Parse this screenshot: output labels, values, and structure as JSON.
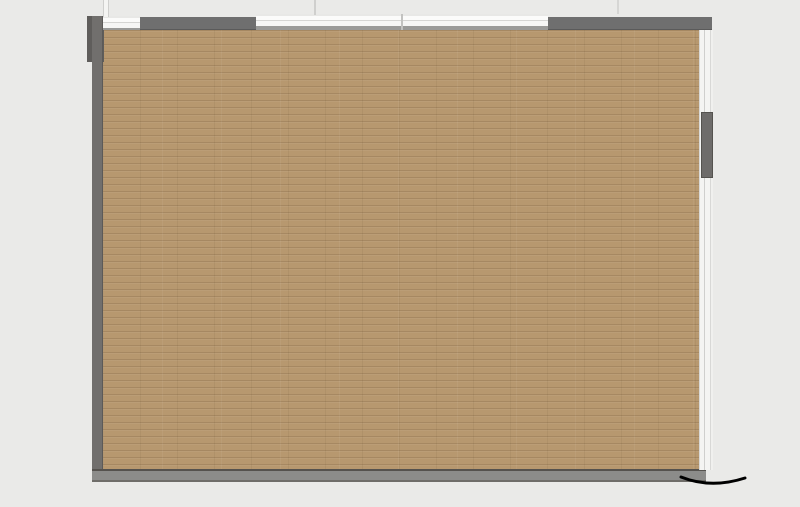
{
  "page": {
    "background": "#eaeae8"
  },
  "logo": {
    "text_en": "SEEWIN",
    "text_cn": "诗敏",
    "color": "#1b48b2"
  },
  "watermark": {
    "text": "SEEWIN 诗敏",
    "opacity": 0.4,
    "row_start": 241,
    "row_step": 44,
    "col_start": 14,
    "col_step": 93,
    "alt_row_offset": 46
  },
  "palette": {
    "floor": "#b7986f",
    "wall": "#716f6d",
    "wood": "#ddb278",
    "white_desk": "#f6f6f5",
    "chair_blue": "#7095c5",
    "chair_gray": "#dee0e1",
    "table_chair": "#7c9bb1",
    "arc_blue": "#27567f",
    "arc_wood": "#e2bc83",
    "hub": "#d9d9d7",
    "pouf_blue": "#4285c6",
    "pouf_orange": "#c88b1e",
    "bench_green": "#9aad55",
    "plant_green": "#2c5426",
    "dark_item": "#45301a",
    "black_item": "#2a2420"
  },
  "furniture": {
    "wood_rects": [
      {
        "name": "partition-panel",
        "x": 258,
        "y": 33,
        "w": 9,
        "h": 117
      },
      {
        "name": "partition-panel",
        "x": 468,
        "y": 32,
        "w": 10,
        "h": 131
      },
      {
        "name": "partition-panel",
        "x": 592,
        "y": 30,
        "w": 11,
        "h": 50
      },
      {
        "name": "shelf-column",
        "x": 100,
        "y": 226,
        "w": 15,
        "h": 172
      },
      {
        "name": "shelf-column",
        "x": 159,
        "y": 227,
        "w": 21,
        "h": 171
      },
      {
        "name": "shelf-column",
        "x": 215,
        "y": 227,
        "w": 22,
        "h": 171
      },
      {
        "name": "shelf-column",
        "x": 269,
        "y": 227,
        "w": 23,
        "h": 171
      },
      {
        "name": "desk-row",
        "x": 505,
        "y": 186,
        "w": 88,
        "h": 21
      },
      {
        "name": "desk-row",
        "x": 505,
        "y": 245,
        "w": 88,
        "h": 22
      },
      {
        "name": "desk-row",
        "x": 505,
        "y": 303,
        "w": 88,
        "h": 20
      },
      {
        "name": "desk-row",
        "x": 505,
        "y": 362,
        "w": 88,
        "h": 23
      },
      {
        "name": "desk-row",
        "x": 505,
        "y": 420,
        "w": 88,
        "h": 22
      },
      {
        "name": "desk-row",
        "x": 613,
        "y": 187,
        "w": 82,
        "h": 20
      },
      {
        "name": "desk-row",
        "x": 613,
        "y": 245,
        "w": 82,
        "h": 22
      },
      {
        "name": "desk-row",
        "x": 613,
        "y": 303,
        "w": 82,
        "h": 20
      },
      {
        "name": "desk-row",
        "x": 613,
        "y": 362,
        "w": 82,
        "h": 23
      },
      {
        "name": "desk-row",
        "x": 613,
        "y": 420,
        "w": 82,
        "h": 22
      },
      {
        "name": "bottom-bench",
        "x": 103,
        "y": 457,
        "w": 332,
        "h": 14
      }
    ],
    "gray_strips": [
      {
        "x": 192,
        "y": 243,
        "w": 11,
        "h": 40
      },
      {
        "x": 192,
        "y": 341,
        "w": 11,
        "h": 43
      },
      {
        "x": 249,
        "y": 243,
        "w": 10,
        "h": 40
      },
      {
        "x": 249,
        "y": 341,
        "w": 10,
        "h": 43
      },
      {
        "x": 522,
        "y": 219,
        "w": 56,
        "h": 10
      },
      {
        "x": 522,
        "y": 278,
        "w": 56,
        "h": 12
      },
      {
        "x": 522,
        "y": 340,
        "w": 56,
        "h": 11
      },
      {
        "x": 522,
        "y": 395,
        "w": 56,
        "h": 11
      },
      {
        "x": 632,
        "y": 219,
        "w": 50,
        "h": 10
      },
      {
        "x": 632,
        "y": 278,
        "w": 50,
        "h": 12
      },
      {
        "x": 632,
        "y": 340,
        "w": 50,
        "h": 11
      },
      {
        "x": 632,
        "y": 395,
        "w": 50,
        "h": 11
      }
    ],
    "planter": {
      "bench": {
        "x": 99,
        "y": 168,
        "w": 101,
        "h": 20
      },
      "base": {
        "x": 99,
        "y": 188,
        "w": 101,
        "h": 5
      },
      "plants": [
        {
          "cx": 105,
          "cy": 196
        },
        {
          "cx": 118,
          "cy": 196
        },
        {
          "cx": 130,
          "cy": 196
        },
        {
          "cx": 143,
          "cy": 196
        },
        {
          "cx": 156,
          "cy": 196
        },
        {
          "cx": 168,
          "cy": 196
        },
        {
          "cx": 181,
          "cy": 196
        },
        {
          "cx": 193,
          "cy": 196
        }
      ]
    },
    "white_desks": [
      {
        "name": "bench-desk",
        "x": 306,
        "y": 31,
        "w": 27,
        "h": 128,
        "cap": {
          "x": 304,
          "y": 161,
          "w": 30,
          "h": 16
        }
      },
      {
        "name": "bench-desk",
        "x": 395,
        "y": 31,
        "w": 27,
        "h": 128,
        "cap": {
          "x": 393,
          "y": 161,
          "w": 30,
          "h": 16
        }
      }
    ],
    "desk_chairs": [
      {
        "x": 287,
        "y": 38,
        "c": "g",
        "side": "l"
      },
      {
        "x": 287,
        "y": 56,
        "c": "b",
        "side": "l"
      },
      {
        "x": 287,
        "y": 77,
        "c": "b",
        "side": "l"
      },
      {
        "x": 287,
        "y": 97,
        "c": "g",
        "side": "l"
      },
      {
        "x": 287,
        "y": 119,
        "c": "b",
        "side": "l"
      },
      {
        "x": 287,
        "y": 139,
        "c": "g",
        "side": "l"
      },
      {
        "x": 336,
        "y": 38,
        "c": "g",
        "side": "r"
      },
      {
        "x": 336,
        "y": 56,
        "c": "g",
        "side": "r"
      },
      {
        "x": 336,
        "y": 77,
        "c": "b",
        "side": "r"
      },
      {
        "x": 336,
        "y": 97,
        "c": "g",
        "side": "r"
      },
      {
        "x": 336,
        "y": 119,
        "c": "b",
        "side": "r"
      },
      {
        "x": 336,
        "y": 139,
        "c": "g",
        "side": "r"
      },
      {
        "x": 377,
        "y": 38,
        "c": "g",
        "side": "l"
      },
      {
        "x": 377,
        "y": 56,
        "c": "g",
        "side": "l"
      },
      {
        "x": 377,
        "y": 77,
        "c": "b",
        "side": "l"
      },
      {
        "x": 377,
        "y": 97,
        "c": "b",
        "side": "l"
      },
      {
        "x": 377,
        "y": 119,
        "c": "g",
        "side": "l"
      },
      {
        "x": 377,
        "y": 139,
        "c": "g",
        "side": "l"
      },
      {
        "x": 425,
        "y": 38,
        "c": "g",
        "side": "r"
      },
      {
        "x": 425,
        "y": 56,
        "c": "b",
        "side": "r"
      },
      {
        "x": 425,
        "y": 77,
        "c": "g",
        "side": "r"
      },
      {
        "x": 425,
        "y": 97,
        "c": "g",
        "side": "r"
      },
      {
        "x": 425,
        "y": 119,
        "c": "b",
        "side": "r"
      },
      {
        "x": 425,
        "y": 139,
        "c": "g",
        "side": "r"
      }
    ],
    "desk_items": [
      {
        "x": 309,
        "y": 33,
        "w": 7,
        "h": 13,
        "f": "#ffffff",
        "rot": -8
      },
      {
        "x": 398,
        "y": 33,
        "w": 7,
        "h": 13,
        "f": "#ffffff",
        "rot": -8
      },
      {
        "x": 324,
        "y": 52,
        "w": 9,
        "h": 15,
        "f": "#2a2420",
        "rot": 0
      },
      {
        "x": 413,
        "y": 52,
        "w": 9,
        "h": 15,
        "f": "#2a2420",
        "rot": 0
      },
      {
        "x": 308,
        "y": 84,
        "w": 8,
        "h": 9,
        "f": "#c9c9c7",
        "rot": 0
      },
      {
        "x": 397,
        "y": 84,
        "w": 8,
        "h": 9,
        "f": "#c9c9c7",
        "rot": 0
      },
      {
        "x": 320,
        "y": 97,
        "w": 12,
        "h": 17,
        "f": "#d8d8d6",
        "rot": 0
      },
      {
        "x": 409,
        "y": 97,
        "w": 12,
        "h": 17,
        "f": "#d8d8d6",
        "rot": 0
      },
      {
        "x": 321,
        "y": 121,
        "w": 9,
        "h": 13,
        "f": "#cfc5b4",
        "rot": 10
      },
      {
        "x": 410,
        "y": 121,
        "w": 9,
        "h": 13,
        "f": "#cfc5b4",
        "rot": 10
      },
      {
        "x": 308,
        "y": 142,
        "w": 7,
        "h": 12,
        "f": "#ffffff",
        "rot": 6
      },
      {
        "x": 397,
        "y": 142,
        "w": 7,
        "h": 12,
        "f": "#ffffff",
        "rot": 6
      },
      {
        "x": 322,
        "y": 142,
        "w": 7,
        "h": 12,
        "f": "#ffffff",
        "rot": -5
      },
      {
        "x": 411,
        "y": 142,
        "w": 7,
        "h": 12,
        "f": "#ffffff",
        "rot": -5
      }
    ],
    "round_tables": [
      {
        "name": "round-table",
        "cx": 543,
        "cy": 96,
        "r": 31,
        "chair_angles": [
          90,
          150,
          210,
          270,
          330,
          30
        ],
        "papers": [
          {
            "x": 516,
            "y": 76,
            "w": 14,
            "h": 12,
            "rot": -20
          },
          {
            "x": 549,
            "y": 75,
            "w": 17,
            "h": 16,
            "rot": 12
          },
          {
            "x": 533,
            "y": 106,
            "w": 15,
            "h": 10,
            "rot": 4
          }
        ],
        "cups": [
          {
            "cx": 536,
            "cy": 89
          },
          {
            "cx": 549,
            "cy": 92
          },
          {
            "cx": 538,
            "cy": 101
          }
        ],
        "dark": {
          "x": 554,
          "y": 100,
          "w": 10,
          "h": 12
        }
      },
      {
        "name": "round-table",
        "cx": 641,
        "cy": 94,
        "r": 29,
        "chair_angles": [
          60,
          120,
          180,
          240,
          300,
          0
        ],
        "papers": [
          {
            "x": 619,
            "y": 71,
            "w": 16,
            "h": 14,
            "rot": -28
          },
          {
            "x": 611,
            "y": 106,
            "w": 14,
            "h": 10,
            "rot": 8
          },
          {
            "x": 655,
            "y": 90,
            "w": 12,
            "h": 11,
            "rot": 15
          }
        ],
        "cups": [
          {
            "cx": 633,
            "cy": 90
          },
          {
            "cx": 644,
            "cy": 94
          },
          {
            "cx": 635,
            "cy": 100
          }
        ],
        "dark": {
          "x": 648,
          "y": 71,
          "w": 9,
          "h": 10
        }
      }
    ],
    "poufs": [
      {
        "c": "blue",
        "cx": 443,
        "cy": 231
      },
      {
        "c": "orange",
        "cx": 343,
        "cy": 250
      },
      {
        "c": "blue",
        "cx": 453,
        "cy": 343
      },
      {
        "c": "blue",
        "cx": 344,
        "cy": 397
      },
      {
        "c": "orange",
        "cx": 422,
        "cy": 396
      }
    ],
    "center_feature": {
      "hub": {
        "cx": 403,
        "cy": 313,
        "r": 16
      },
      "arcs": [
        {
          "cx": 403,
          "cy": 311,
          "r1": 41,
          "r2": 62,
          "a_start": 155,
          "a_end": -10,
          "colors": [
            "blue",
            "wood",
            "blue",
            "wood",
            "blue"
          ]
        },
        {
          "cx": 400,
          "cy": 315,
          "r1": 42,
          "r2": 64,
          "a_start": 178,
          "a_end": 313,
          "colors": [
            "blue",
            "wood",
            "blue",
            "wood",
            "blue"
          ]
        }
      ]
    }
  }
}
